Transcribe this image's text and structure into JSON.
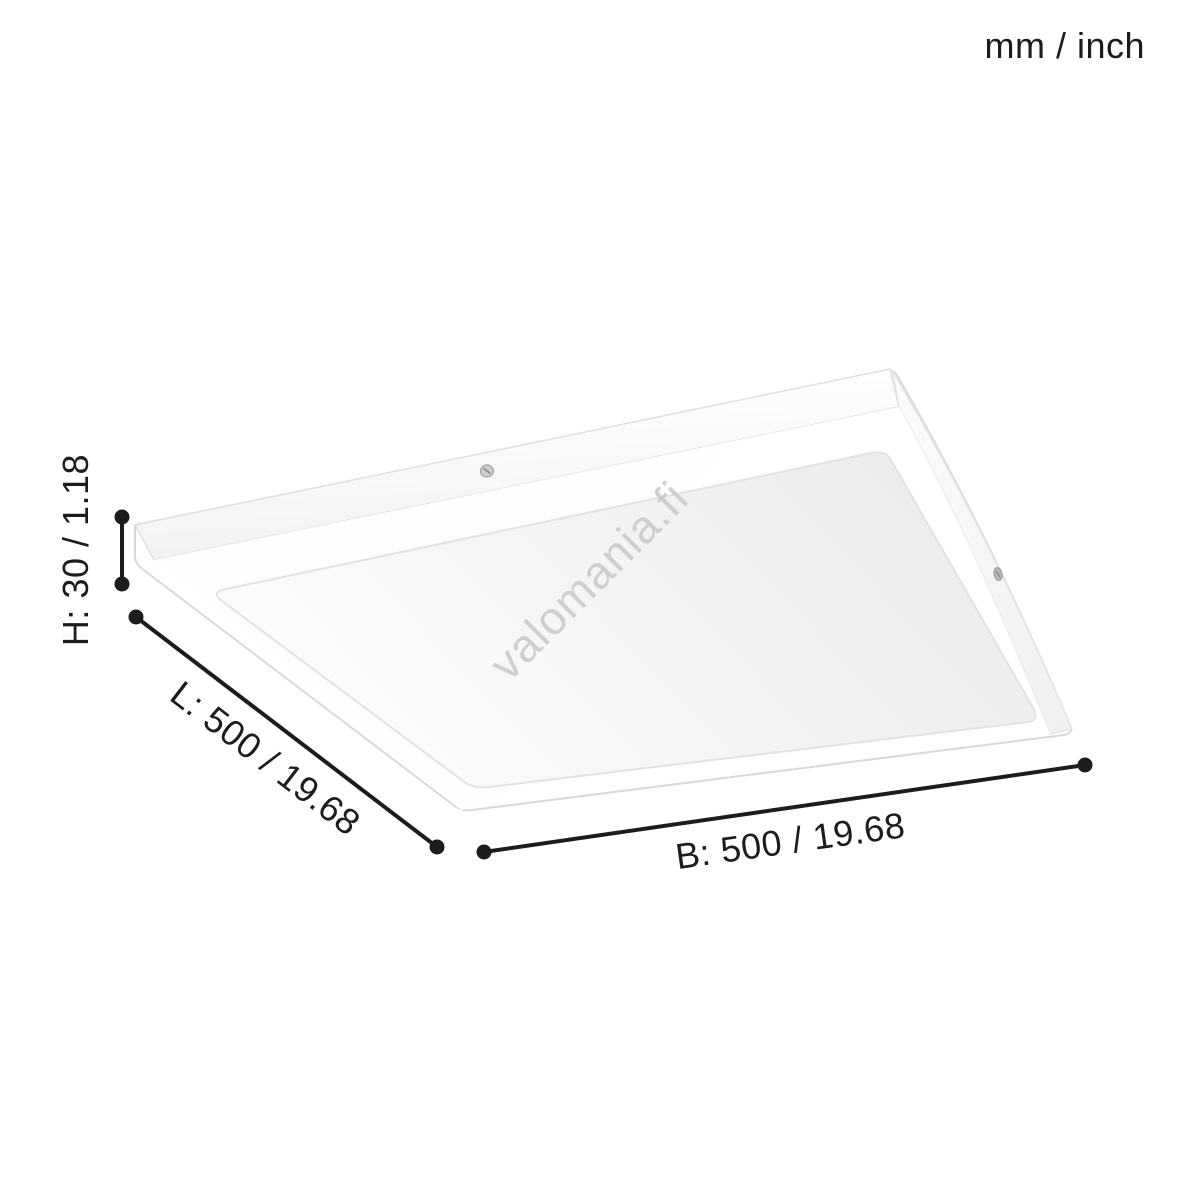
{
  "units_label": "mm / inch",
  "watermark": "valomania.fi",
  "dimensions": {
    "height": {
      "axis": "H",
      "label": "H: 30 / 1.18",
      "mm": "30",
      "inch": "1.18"
    },
    "length": {
      "axis": "L",
      "label": "L: 500 / 19.68",
      "mm": "500",
      "inch": "19.68"
    },
    "width": {
      "axis": "B",
      "label": "B: 500 / 19.68",
      "mm": "500",
      "inch": "19.68"
    }
  },
  "icons": {
    "screw_top": "screw-icon",
    "screw_right": "screw-icon"
  },
  "colors": {
    "ink": "#1c1c1c",
    "watermark": "#cbcbcb",
    "background": "#ffffff",
    "panel_edge": "#d8d8d8",
    "diffuser_seam": "#e2e2e2"
  }
}
